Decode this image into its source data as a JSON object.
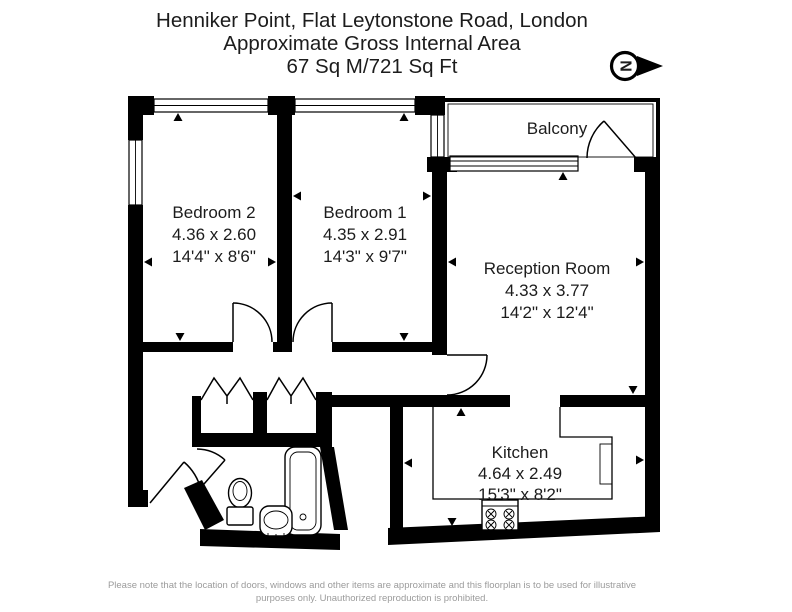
{
  "title": {
    "line1": "Henniker Point, Flat Leytonstone Road, London",
    "line2": "Approximate Gross Internal Area",
    "line3": "67 Sq M/721 Sq Ft"
  },
  "compass": {
    "letter": "N"
  },
  "rooms": [
    {
      "name": "Bedroom 2",
      "metric": "4.36 x 2.60",
      "imperial": "14'4\" x 8'6\""
    },
    {
      "name": "Bedroom 1",
      "metric": "4.35 x 2.91",
      "imperial": "14'3\" x 9'7\""
    },
    {
      "name": "Reception Room",
      "metric": "4.33 x 3.77",
      "imperial": "14'2\" x 12'4\""
    },
    {
      "name": "Kitchen",
      "metric": "4.64 x 2.49",
      "imperial": "15'3\" x 8'2\""
    },
    {
      "name": "Balcony"
    }
  ],
  "footer": {
    "line1": "Please note that the location of doors, windows and other items are approximate and this floorplan is to be used for illustrative",
    "line2": "purposes only. Unauthorized reproduction is prohibited."
  },
  "colors": {
    "walls": "#000000",
    "text": "#1c1c1c",
    "footer_text": "#9b9b9b"
  }
}
